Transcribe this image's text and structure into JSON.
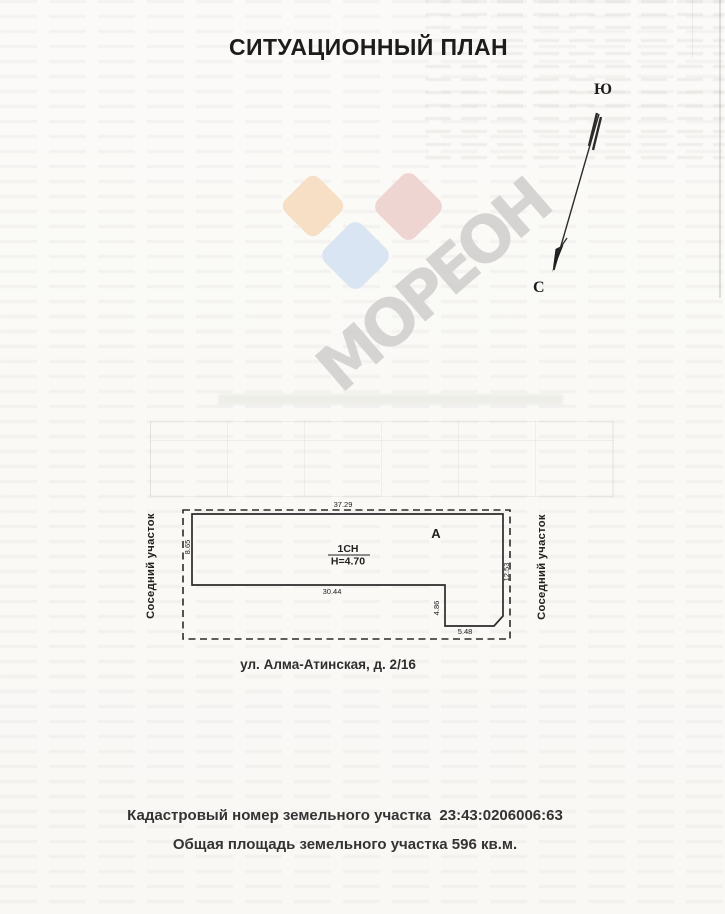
{
  "document": {
    "title": "СИТУАЦИОННЫЙ ПЛАН"
  },
  "compass": {
    "south": "Ю",
    "north": "С"
  },
  "watermark": {
    "text": "МОРЕОН"
  },
  "brand_colors": {
    "orange": "#f6dfc4",
    "pink": "#efd5d1",
    "blue": "#d9e5f3"
  },
  "ink_color": "#2b2b2b",
  "plan": {
    "neighbor_left": "Соседний участок",
    "neighbor_right": "Соседний участок",
    "section_letter": "А",
    "building_code": "1СН",
    "building_height": "Н=4.70",
    "dim_top": "37.29",
    "dim_bottom": "30.44",
    "dim_step_height": "4.86",
    "dim_step_width": "5.48",
    "dim_right": "12.53",
    "dim_left": "8.65",
    "address": "ул. Алма-Атинская, д. 2/16"
  },
  "footer": {
    "cadastral": "Кадастровый номер земельного участка  23:43:0206006:63",
    "area": "Общая площадь земельного участка 596 кв.м."
  }
}
